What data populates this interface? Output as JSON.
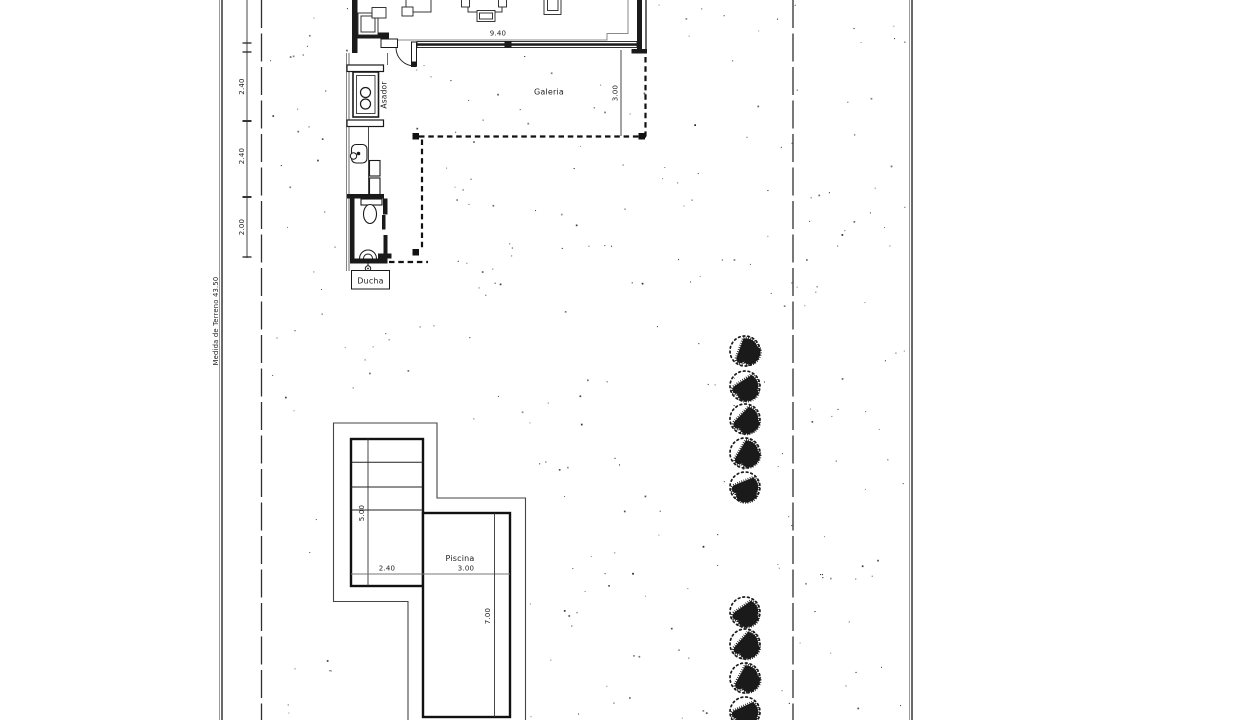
{
  "plan": {
    "paper_color": "#ffffff",
    "ink_color": "#1a1a1a",
    "gray_color": "#8a8a8a",
    "terrain": {
      "label": "Medida de Terreno 43.50"
    },
    "boundary_dims": [
      {
        "value": "2.40"
      },
      {
        "value": "2.40"
      },
      {
        "value": "2.00"
      }
    ],
    "building": {
      "width_dim": "9.40"
    },
    "galeria": {
      "label": "Galeria",
      "depth_dim": "3.00"
    },
    "asador": {
      "label": "Asador"
    },
    "ducha": {
      "label": "Ducha"
    },
    "piscina": {
      "label": "Piscina",
      "left_length_dim": "5.00",
      "left_width_dim": "2.40",
      "right_width_dim": "3.00",
      "right_length_dim": "7.00"
    },
    "trees": {
      "column_x": 745,
      "radius": 16.5,
      "group1_y": [
        351,
        386,
        419,
        453,
        487
      ],
      "group2_y": [
        612,
        644,
        678,
        712
      ]
    }
  }
}
